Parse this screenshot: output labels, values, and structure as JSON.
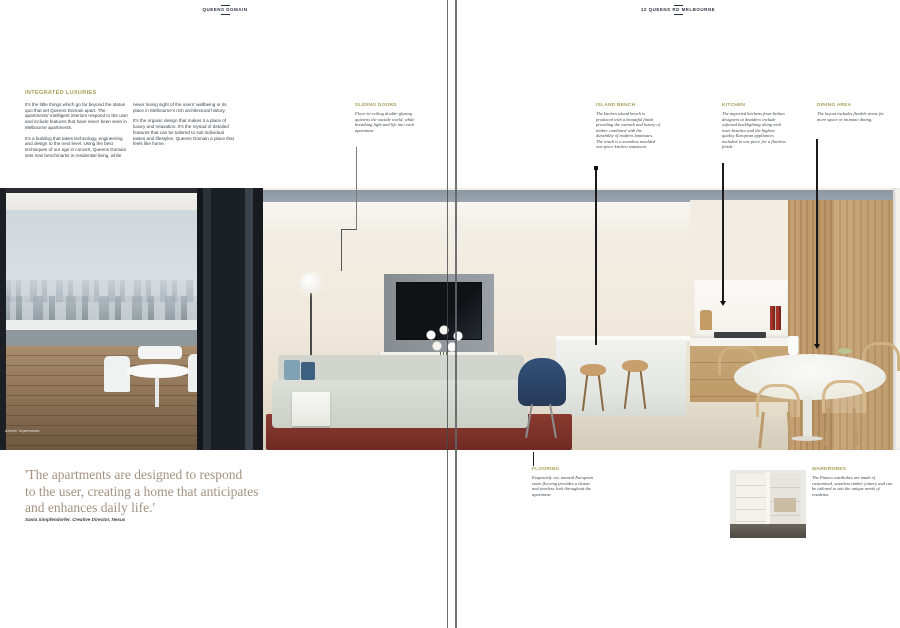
{
  "masthead": {
    "left": "QUEENS DOMAIN",
    "right": "12 QUEENS RD MELBOURNE"
  },
  "intro": {
    "heading": "INTEGRATED LUXURIES",
    "col1": {
      "p1": "It's the little things which go far beyond the status quo that set Queens Domain apart. The apartments' intelligent interiors respond to the user and include features that have never been seen in Melbourne apartments.",
      "p2": "It's a building that takes technology, engineering and design to the next level. Using the best techniques of our age in concert, Queens Domain sets new benchmarks in residential living, while"
    },
    "col2": {
      "p1": "never losing sight of the users' wellbeing or its place in Melbourne's rich architectural history.",
      "p2": "It's the organic design that makes it a place of luxury and relaxation. It's the myriad of detailed features that can be tailored to suit individual tastes and lifestyles. Queens Domain a place that feels like home."
    }
  },
  "callouts": {
    "sliding_doors": {
      "heading": "SLIDING DOORS",
      "body": "Floor-to-ceiling double-glazing quietens the outside world, while breathing light and life into each apartment."
    },
    "island_bench": {
      "heading": "ISLAND BENCH",
      "body": "The kitchen island bench is produced with a beautiful finish providing the warmth and luxury of timber combined with the durability of modern laminates. The result is a seamless moulded one-piece kitchen statement."
    },
    "kitchen": {
      "heading": "KITCHEN",
      "body": "The imported kitchens from Italian designers at Snaidero include softened backlighting along with inset benches and the highest quality European appliances included in one piece for a flawless finish."
    },
    "dining_area": {
      "heading": "DINING AREA",
      "body": "The layout includes flexible areas for more space or intimate dining."
    },
    "flooring": {
      "heading": "FLOORING",
      "body": "Exquisitely cut, natural European stone flooring provides a classic and timeless look throughout the apartment."
    },
    "wardrobes": {
      "heading": "WARDROBES",
      "body": "The Pianca wardrobes are made of customised, seamless timber joinery and can be tailored to suit the unique needs of residents."
    }
  },
  "quote": {
    "lines": [
      "'The apartments are designed to respond",
      "to the user, creating a home that anticipates",
      "and enhances daily life.'"
    ],
    "attribution": "Sania Simpfendorfer. Creative Director, Nexus"
  },
  "photo": {
    "caption": "Artists' Impression"
  },
  "colors": {
    "accent_gold": "#a79e55",
    "quote_taupe": "#a29180",
    "body_ink": "#3d404b",
    "rug_red": "#7e342c",
    "chair_navy": "#2c4263"
  }
}
